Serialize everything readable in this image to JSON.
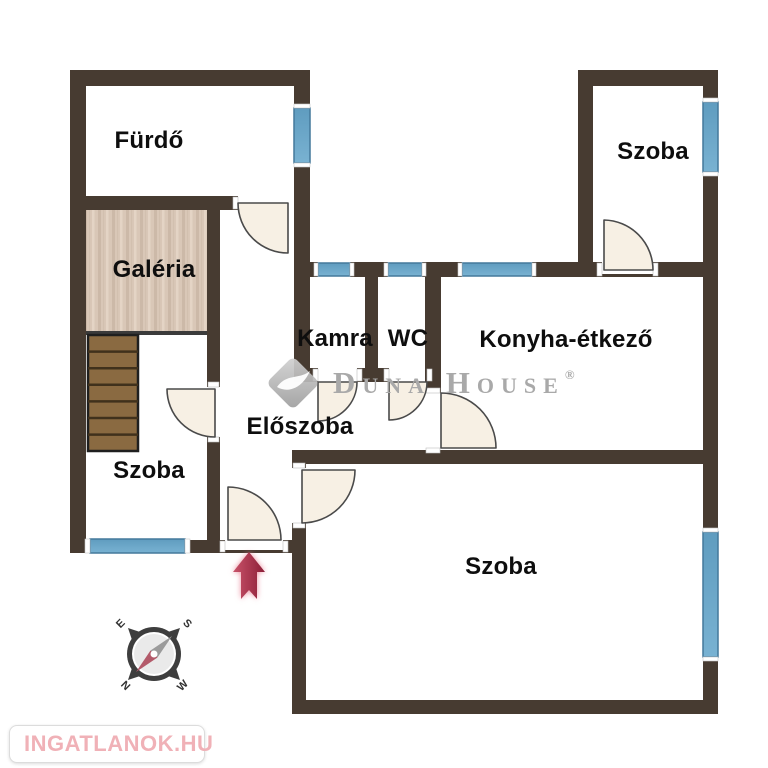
{
  "rooms": {
    "furdo": "Fürdő",
    "galeria": "Galéria",
    "szoba_top": "Szoba",
    "kamra": "Kamra",
    "wc": "WC",
    "konyha": "Konyha-étkező",
    "eloszoba": "Előszoba",
    "szoba_left": "Szoba",
    "szoba_bottom": "Szoba"
  },
  "watermark": {
    "brand": "Duna House",
    "registered": "®"
  },
  "compass": {
    "north": "N",
    "east": "E",
    "south": "S",
    "west": "W"
  },
  "footer_logo": {
    "text": "INGATLANOK.HU"
  },
  "colors": {
    "wall": "#473b31",
    "window_blue": "#6ba7c9",
    "door_leaf": "#f7f0e4",
    "galeria_floor": "#d9c7b7",
    "stairs_wood": "#8a6a41",
    "entrance_arrow": "#a32744",
    "watermark_gray": "#a9a9a9",
    "logo_pink": "#f0b1b7"
  }
}
